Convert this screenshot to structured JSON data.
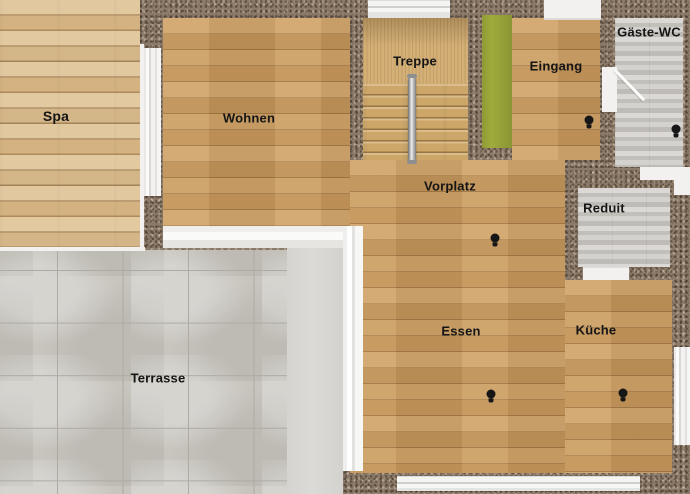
{
  "rooms": {
    "spa": {
      "label": "Spa"
    },
    "wohnen": {
      "label": "Wohnen"
    },
    "treppe": {
      "label": "Treppe"
    },
    "eingang": {
      "label": "Eingang"
    },
    "gaeste_wc": {
      "label": "Gäste-WC"
    },
    "vorplatz": {
      "label": "Vorplatz"
    },
    "reduit": {
      "label": "Reduit"
    },
    "essen": {
      "label": "Essen"
    },
    "kueche": {
      "label": "Küche"
    },
    "terrasse": {
      "label": "Terrasse"
    }
  },
  "icons": {
    "ceiling_light": {
      "name": "ceiling-light-icon",
      "count": 5
    }
  },
  "colors": {
    "wall_brown": "#8d7c6c",
    "oak_floor": "#cb9b5e",
    "pine_floor": "#dcbd8d",
    "stone_floor": "#cbc8c3",
    "terrace_tile": "#c8c5be",
    "accent_green": "#9fab3c",
    "window_white": "#f2f1ef",
    "handrail_chrome": "#c8c8c8",
    "label_text": "#151515"
  }
}
